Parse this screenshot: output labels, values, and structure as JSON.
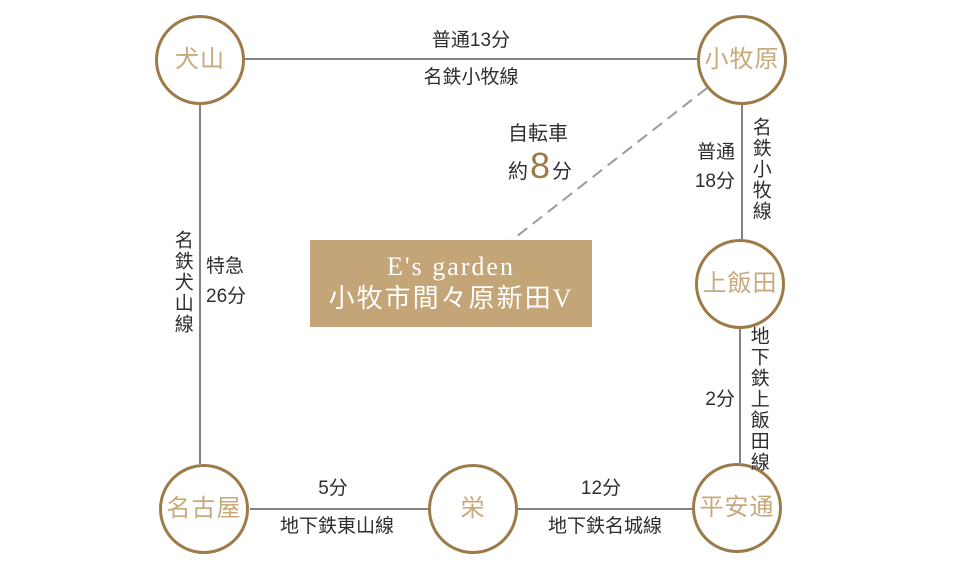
{
  "colors": {
    "accent": "#9c7b49",
    "station_text": "#c8a97b",
    "box_bg": "#c3a578",
    "box_text": "#ffffff",
    "rail_line": "#828282",
    "dash_line": "#9b9b9b",
    "label_text": "#2e2e2e"
  },
  "stations": {
    "inuyama": "犬山",
    "komakihara": "小牧原",
    "kamiiida": "上飯田",
    "heiandori": "平安通",
    "sakae": "栄",
    "nagoya": "名古屋"
  },
  "routes": {
    "inuyama_komakihara": {
      "time": "普通13分",
      "line": "名鉄小牧線"
    },
    "nagoya_inuyama": {
      "service": "特急",
      "time": "26分",
      "line": "名鉄犬山線"
    },
    "komakihara_kamiiida": {
      "service": "普通",
      "time": "18分",
      "line": "名鉄小牧線"
    },
    "kamiiida_heiandori": {
      "time": "2分",
      "line": "地下鉄上飯田線"
    },
    "nagoya_sakae": {
      "time": "5分",
      "line": "地下鉄東山線"
    },
    "sakae_heiandori": {
      "time": "12分",
      "line": "地下鉄名城線"
    }
  },
  "bicycle": {
    "mode": "自転車",
    "approx": "約",
    "minutes": "8",
    "unit": "分"
  },
  "property": {
    "name_en": "E's garden",
    "name_jp": "小牧市間々原新田V"
  }
}
